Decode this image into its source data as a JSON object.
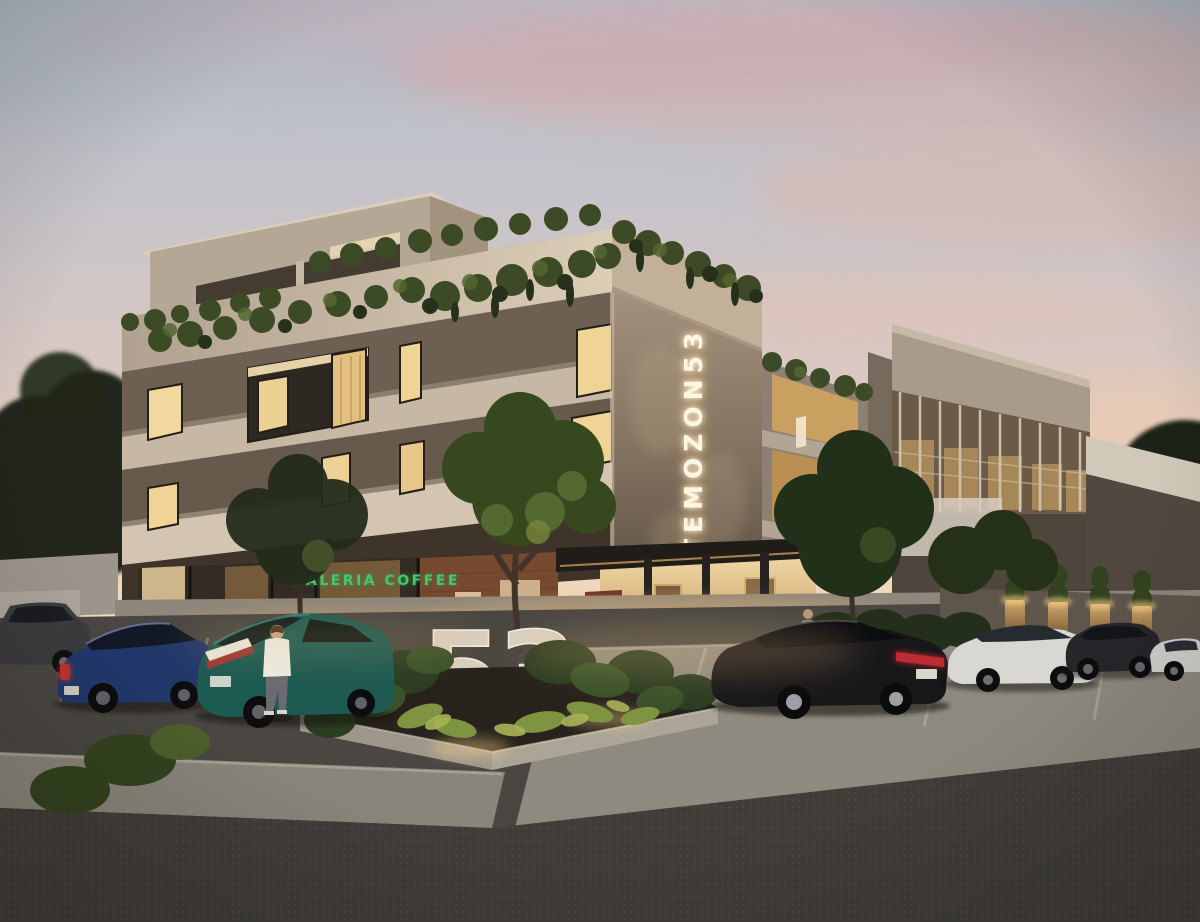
{
  "scene": {
    "type": "architectural-render",
    "setting": "modern three-story mixed-use building at dusk with rooftop vines, ground-floor cafe, corner entrance and street parking",
    "time_of_day": "dusk"
  },
  "signage": {
    "vertical_sign_text": "TEMOZON53",
    "monument_sign_text": "53",
    "storefront_sign_text": "GALERIA COFFEE"
  },
  "palette": {
    "sky_top": "#b7c0cb",
    "sky_pink": "#ddb0a8",
    "sky_horizon": "#f2d8bd",
    "concrete_light": "#d3c5b1",
    "concrete_mid": "#a3968a",
    "stone_dark": "#6e6152",
    "window_glow": "#f2d79e",
    "foliage_dark": "#2d3a20",
    "foliage_light": "#8fa04c",
    "asphalt": "#44413d",
    "sidewalk": "#a29c92",
    "neon_sign": "#fff6e2",
    "cafe_sign_green": "#46c76c"
  },
  "vehicles": [
    {
      "name": "suv-far-left",
      "color": "#3c3b3d"
    },
    {
      "name": "sedan-navy",
      "color": "#22386b"
    },
    {
      "name": "hatchback-teal",
      "color": "#1d5a52"
    },
    {
      "name": "sedan-black",
      "color": "#17171a"
    },
    {
      "name": "sedan-white",
      "color": "#d9d7d2"
    },
    {
      "name": "suv-dark",
      "color": "#26262a"
    },
    {
      "name": "car-white-far-right",
      "color": "#cfcecb"
    }
  ],
  "people": [
    {
      "name": "man-standing-by-teal-car",
      "shirt": "#eceae2"
    },
    {
      "name": "person-walking-near-entrance",
      "shirt": "#8d857c"
    }
  ]
}
